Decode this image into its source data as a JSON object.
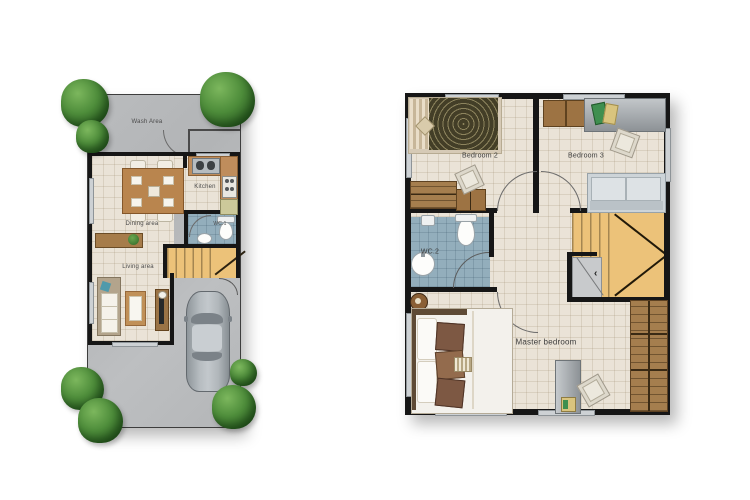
{
  "ground_floor": {
    "labels": {
      "wash_area": "Wash Area",
      "kitchen": "Kitchen",
      "wc1": "WC.1",
      "dining": "Dining area",
      "living": "Living area"
    }
  },
  "upper_floor": {
    "labels": {
      "bedroom2": "Bedroom 2",
      "bedroom3": "Bedroom 3",
      "wc2": "WC.2",
      "master": "Master bedroom"
    }
  },
  "palette": {
    "wall": "#161616",
    "floor_tile": "#eae3d7",
    "concrete": "#b6b8ba",
    "wc_floor": "#93aebc",
    "stairs_wood": "#ecc279",
    "tree_green": "#4d8c3a",
    "counter_wood": "#bf8d5c",
    "wardrobe_wood": "#a57e4e",
    "car_body": "#a2a8ad"
  }
}
